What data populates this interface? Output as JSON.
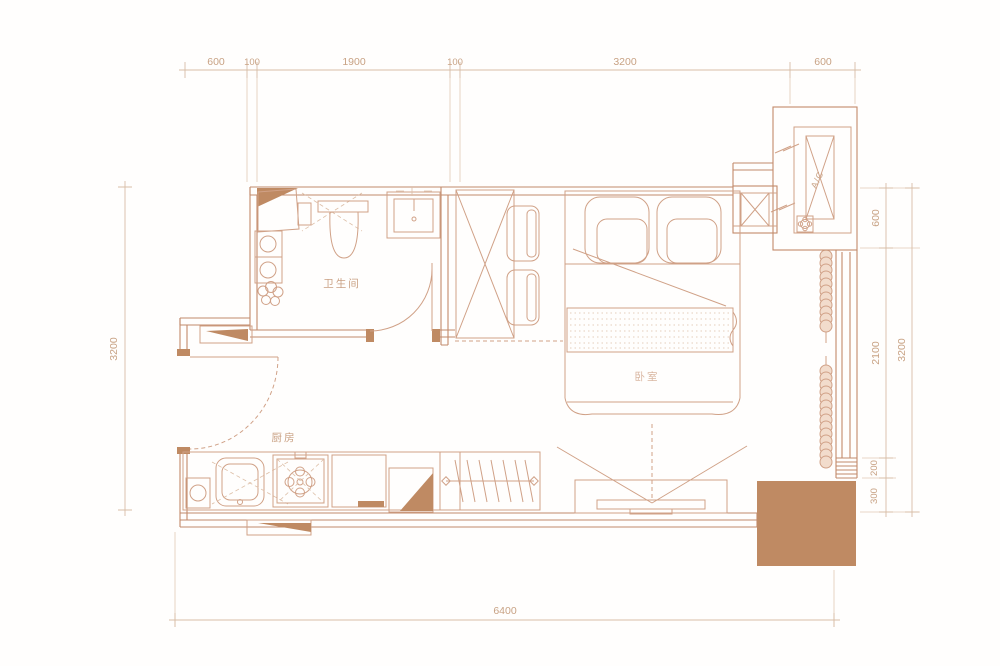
{
  "page": {
    "background": "#ffffff"
  },
  "palette": {
    "wall_line": "#c28a6b",
    "furniture_line": "#d0a187",
    "dimension_line": "#d8bda6",
    "dimension_text": "#c8a284",
    "accent_fill": "#bf8a63"
  },
  "rooms": {
    "bathroom": "卫生间",
    "kitchen": "厨房",
    "bedroom": "卧室"
  },
  "equipment": {
    "ac_unit": "A/C"
  },
  "dimensions": {
    "top": [
      "600",
      "100",
      "1900",
      "100",
      "3200",
      "600"
    ],
    "left": [
      "3200"
    ],
    "right_inner": [
      "600",
      "2100",
      "200",
      "300"
    ],
    "right_outer": [
      "3200"
    ],
    "bottom": [
      "6400"
    ]
  }
}
